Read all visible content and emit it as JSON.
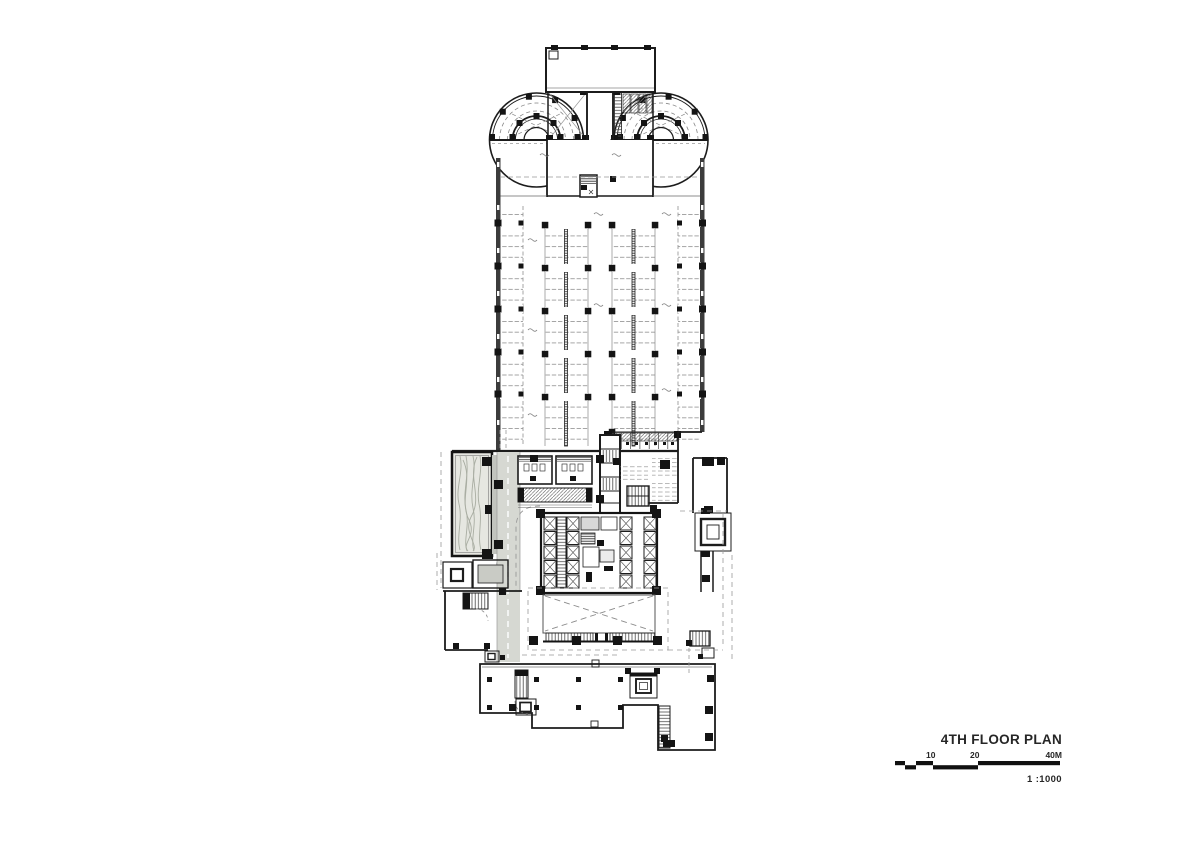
{
  "sheet": {
    "background": "#ffffff"
  },
  "title_block": {
    "title": "4TH FLOOR PLAN",
    "scale_text": "1 :1000",
    "scale_bar": {
      "label_10": "10",
      "label_20": "20",
      "label_40": "40M"
    }
  },
  "colors": {
    "paper": "#ffffff",
    "ink": "#1c1c1c",
    "line_gray": "#8f8f8f",
    "wall_dark": "#3c3c3c",
    "fill_gray": "#d6d8d2",
    "fill_dark_gray": "#c2c4be",
    "landscape_fill": "#e6e7e1",
    "wave_gray": "#a9ada2"
  },
  "plan": {
    "features": [
      "roof-block",
      "helical-ramp-west",
      "helical-ramp-east",
      "ramp-link-corridor",
      "parking-deck",
      "parking-stalls",
      "drive-aisles",
      "structural-columns",
      "service-band",
      "toilet-rooms",
      "landscape-deck",
      "service-corridor",
      "central-shaft",
      "elevator-bank",
      "stair-cores",
      "atrium-void",
      "skylights",
      "lower-floor-plates",
      "east-service-wing",
      "setback-dashed-lines"
    ]
  }
}
